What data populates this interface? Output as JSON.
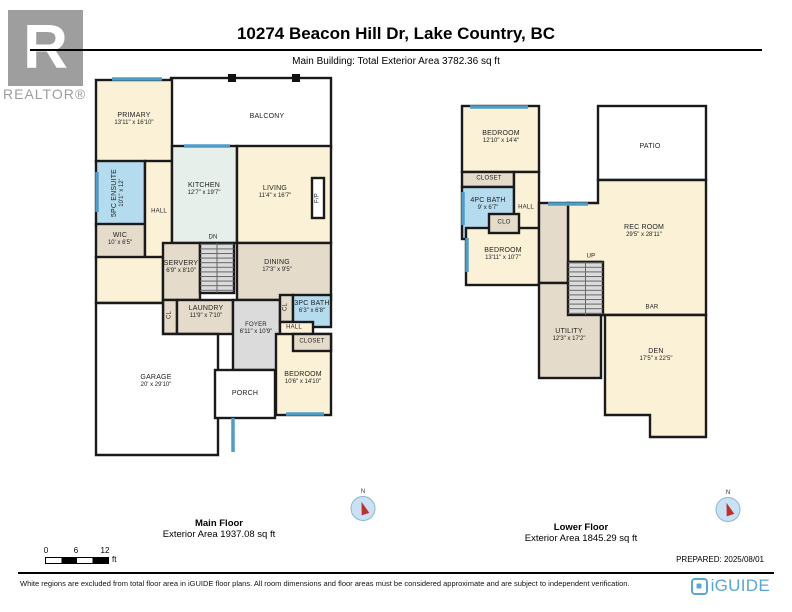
{
  "header": {
    "logo_text": "R",
    "logo_caption": "REALTOR®",
    "title": "10274 Beacon Hill Dr, Lake Country, BC",
    "subtitle": "Main Building: Total Exterior Area 3782.36 sq ft"
  },
  "floors": {
    "main": {
      "title": "Main Floor",
      "area": "Exterior Area 1937.08 sq ft",
      "compass_label": "N",
      "rooms": {
        "balcony": {
          "name": "BALCONY"
        },
        "primary": {
          "name": "PRIMARY",
          "dims": "13'11\" x 16'10\""
        },
        "ensuite": {
          "name": "5PC ENSUITE",
          "dims": "10'1\" x 12'"
        },
        "wic": {
          "name": "WIC",
          "dims": "10' x 6'5\""
        },
        "hall_upper": {
          "name": "HALL"
        },
        "kitchen": {
          "name": "KITCHEN",
          "dims": "12'7\" x 19'7\""
        },
        "living": {
          "name": "LIVING",
          "dims": "11'4\" x 16'7\""
        },
        "fireplace": {
          "name": "F/P"
        },
        "servery": {
          "name": "SERVERY",
          "dims": "6'9\" x 8'10\""
        },
        "stairs_dn": {
          "name": "DN"
        },
        "dining": {
          "name": "DINING",
          "dims": "17'3\" x 9'5\""
        },
        "cl_laundry": {
          "name": "CL"
        },
        "laundry": {
          "name": "LAUNDRY",
          "dims": "11'9\" x 7'10\""
        },
        "foyer": {
          "name": "FOYER",
          "dims": "6'11\" x 10'9\""
        },
        "cl_bath": {
          "name": "CL"
        },
        "bath": {
          "name": "3PC BATH",
          "dims": "6'3\" x 6'8\""
        },
        "hall_lower": {
          "name": "HALL"
        },
        "closet": {
          "name": "CLOSET"
        },
        "bedroom": {
          "name": "BEDROOM",
          "dims": "10'6\" x 14'10\""
        },
        "garage": {
          "name": "GARAGE",
          "dims": "20' x 29'10\""
        },
        "porch": {
          "name": "PORCH"
        }
      }
    },
    "lower": {
      "title": "Lower Floor",
      "area": "Exterior Area 1845.29 sq ft",
      "compass_label": "N",
      "rooms": {
        "bedroom1": {
          "name": "BEDROOM",
          "dims": "12'10\" x 14'4\""
        },
        "patio": {
          "name": "PATIO"
        },
        "closet1": {
          "name": "CLOSET"
        },
        "bath": {
          "name": "4PC BATH",
          "dims": "9' x 6'7\""
        },
        "hall": {
          "name": "HALL"
        },
        "clo": {
          "name": "CLO"
        },
        "bedroom2": {
          "name": "BEDROOM",
          "dims": "13'11\" x 10'7\""
        },
        "recroom": {
          "name": "REC ROOM",
          "dims": "29'5\" x 28'11\""
        },
        "stairs_up": {
          "name": "UP"
        },
        "bar": {
          "name": "BAR"
        },
        "utility": {
          "name": "UTILITY",
          "dims": "12'3\" x 17'2\""
        },
        "den": {
          "name": "DEN",
          "dims": "17'5\" x 22'5\""
        }
      }
    }
  },
  "scale_bar": {
    "tick0": "0",
    "tick6": "6",
    "tick12": "12",
    "unit": "ft"
  },
  "prepared_label": "PREPARED: 2025/08/01",
  "footer": {
    "disclaimer": "White regions are excluded from total floor area in iGUIDE floor plans. All room dimensions and floor areas must be considered approximate and are subject to independent verification.",
    "brand": "iGUIDE"
  },
  "colors": {
    "room_cream": "#FAF1D6",
    "room_blue": "#B5DCEE",
    "room_green": "#E6EFE9",
    "room_tan": "#E5DBCB",
    "room_gray": "#DBDBDB",
    "window_blue": "#4E9CC8",
    "wall": "#1A1A1A",
    "brand_blue": "#59A8D4"
  }
}
